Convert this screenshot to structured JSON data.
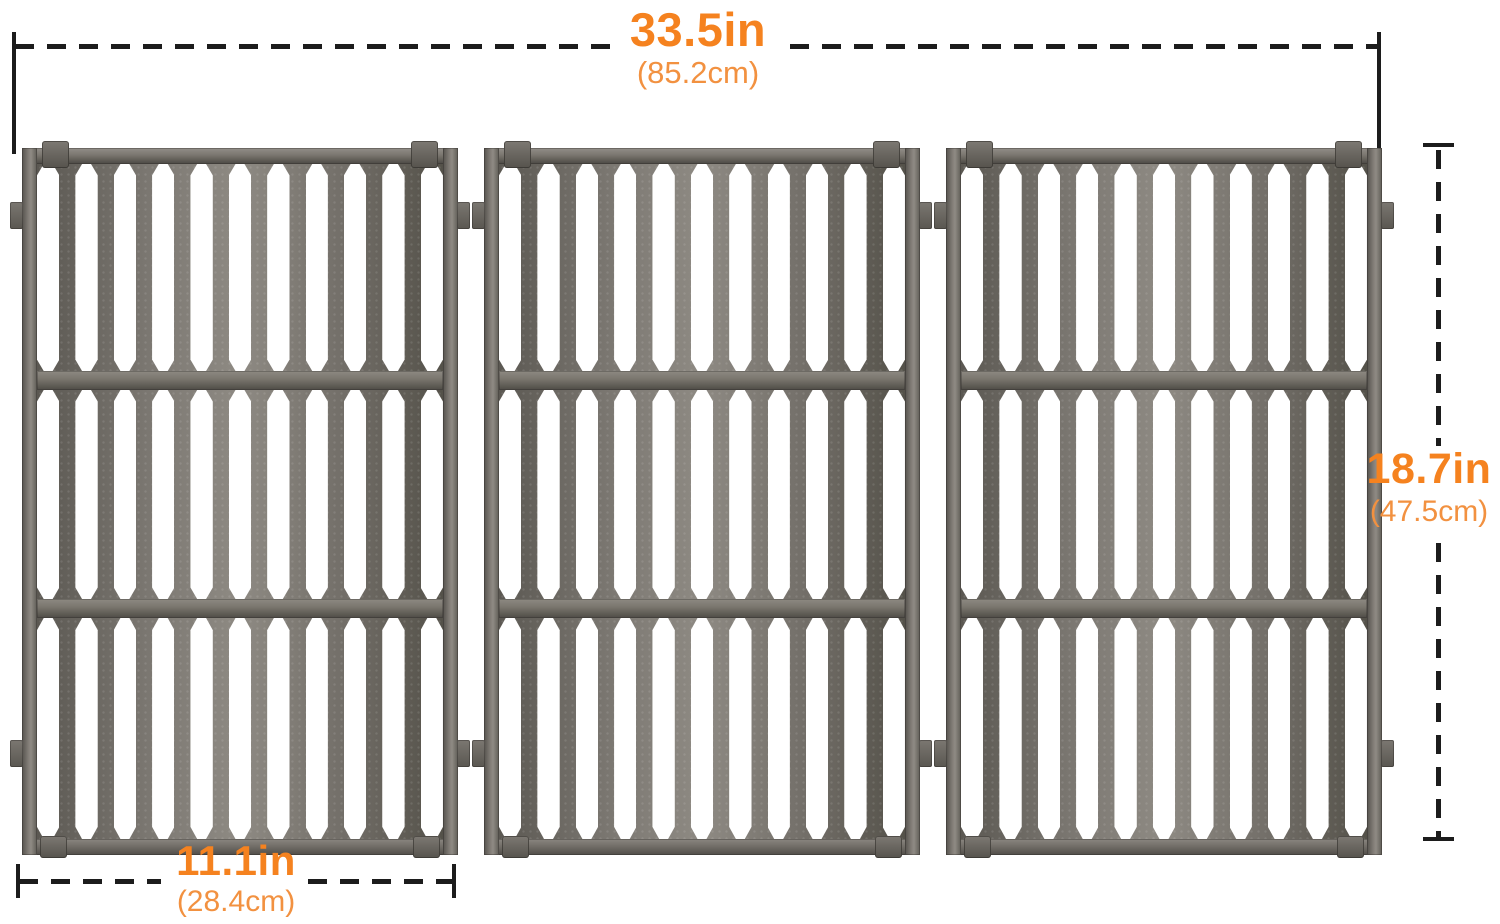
{
  "image_type": "product-dimension-diagram",
  "colors": {
    "accent": "#F5821F",
    "accent_light": "#F29140",
    "line": "#1C1C1C",
    "background": "#FFFFFF",
    "metal_base": "#7A766F",
    "metal_dark": "#514E49",
    "metal_light": "#8F8B84"
  },
  "dimensions": {
    "width": {
      "value": "33.5in",
      "metric": "(85.2cm)"
    },
    "height": {
      "value": "18.7in",
      "metric": "(47.5cm)"
    },
    "panel": {
      "value": "11.1in",
      "metric": "(28.4cm)"
    }
  },
  "product": {
    "name": "cast-iron-grill-cooking-grates",
    "grate_count": 3,
    "sections_per_grate": 3,
    "slots_per_section": 11,
    "crossbars_per_grate": 2
  }
}
